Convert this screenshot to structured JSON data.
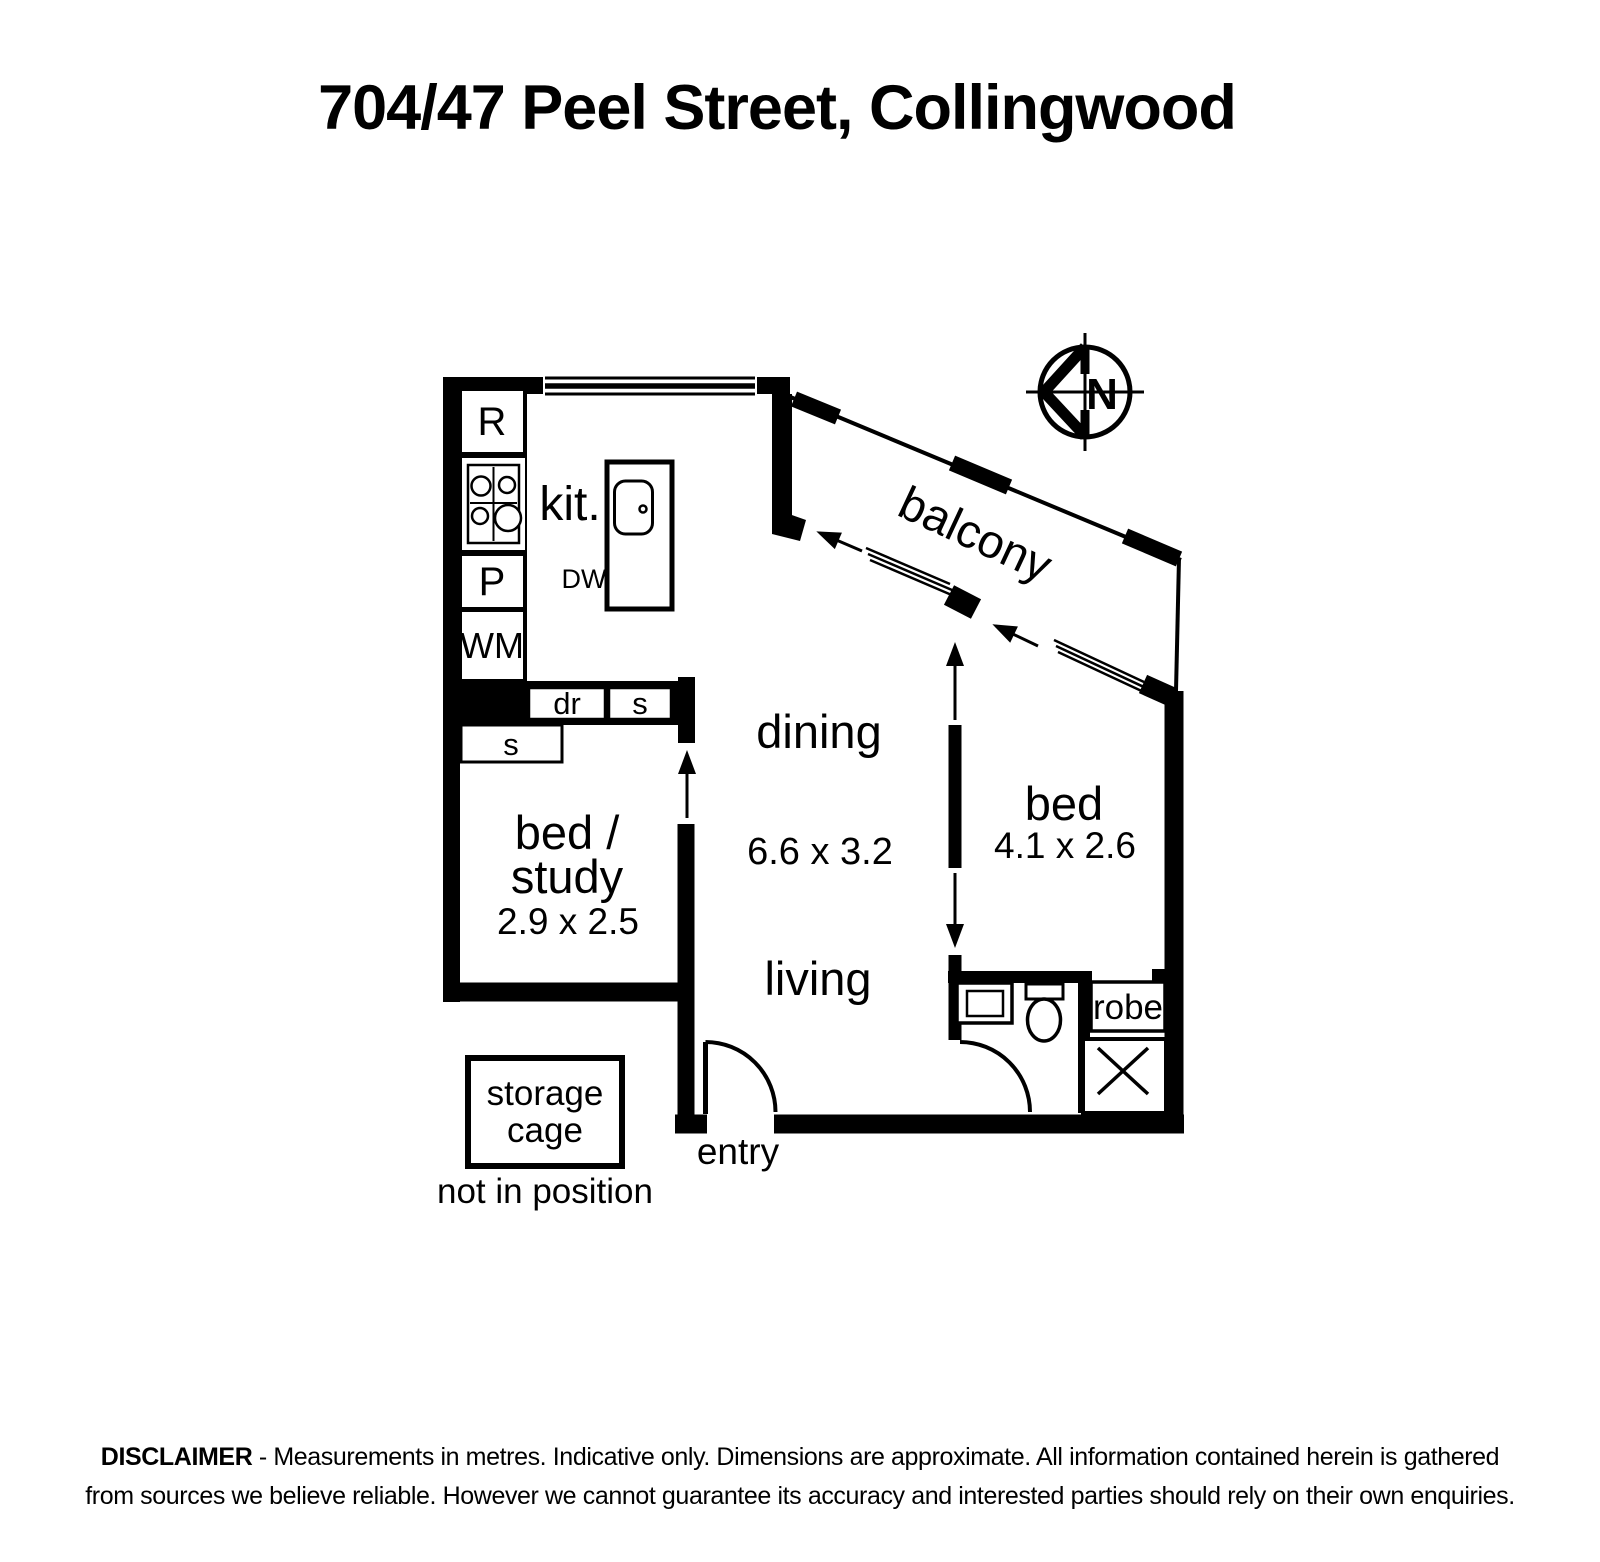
{
  "title": "704/47 Peel Street, Collingwood",
  "compass": {
    "north": "N"
  },
  "plan": {
    "kitchen": {
      "label": "kit.",
      "dishwasher": "DW",
      "fridge": "R",
      "pantry": "P",
      "washer": "WM",
      "drawers": "dr",
      "shelf_a": "s",
      "shelf_b": "s"
    },
    "dining": {
      "label": "dining",
      "dims": "6.6 x 3.2"
    },
    "living": {
      "label": "living"
    },
    "bed_study": {
      "line1": "bed /",
      "line2": "study",
      "dims": "2.9 x 2.5"
    },
    "bed": {
      "label": "bed",
      "dims": "4.1 x 2.6"
    },
    "balcony": {
      "label": "balcony"
    },
    "bath": {
      "robe": "robe"
    },
    "entry": {
      "label": "entry"
    },
    "storage": {
      "line1": "storage",
      "line2": "cage",
      "note": "not in position"
    }
  },
  "disclaimer": {
    "heading": "DISCLAIMER",
    "line1": " - Measurements in metres. Indicative only. Dimensions are approximate. All information contained herein is gathered",
    "line2": "from sources we believe reliable. However we cannot guarantee its accuracy and interested parties should rely on their own enquiries."
  },
  "colors": {
    "ink": "#000000",
    "background": "#ffffff"
  }
}
